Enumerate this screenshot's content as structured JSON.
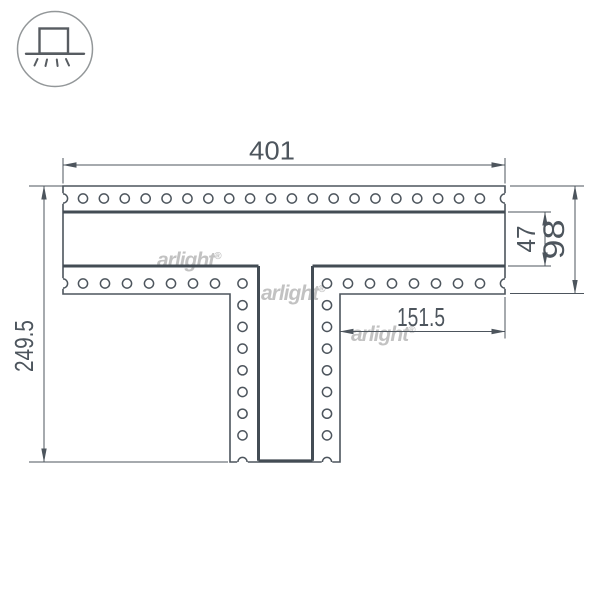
{
  "icon": {
    "name": "recessed-mount-icon"
  },
  "watermarks": {
    "brand": "arlight",
    "registered_mark": "®"
  },
  "dimensions": {
    "width_total": "401",
    "height_total": "249.5",
    "channel_width": "47",
    "flange_width": "98",
    "right_flange_length": "151.5"
  },
  "colors": {
    "line": "#4d555d",
    "channel_line": "#434c54",
    "watermark": "#c2c2c2",
    "icon_ring": "#939799"
  }
}
